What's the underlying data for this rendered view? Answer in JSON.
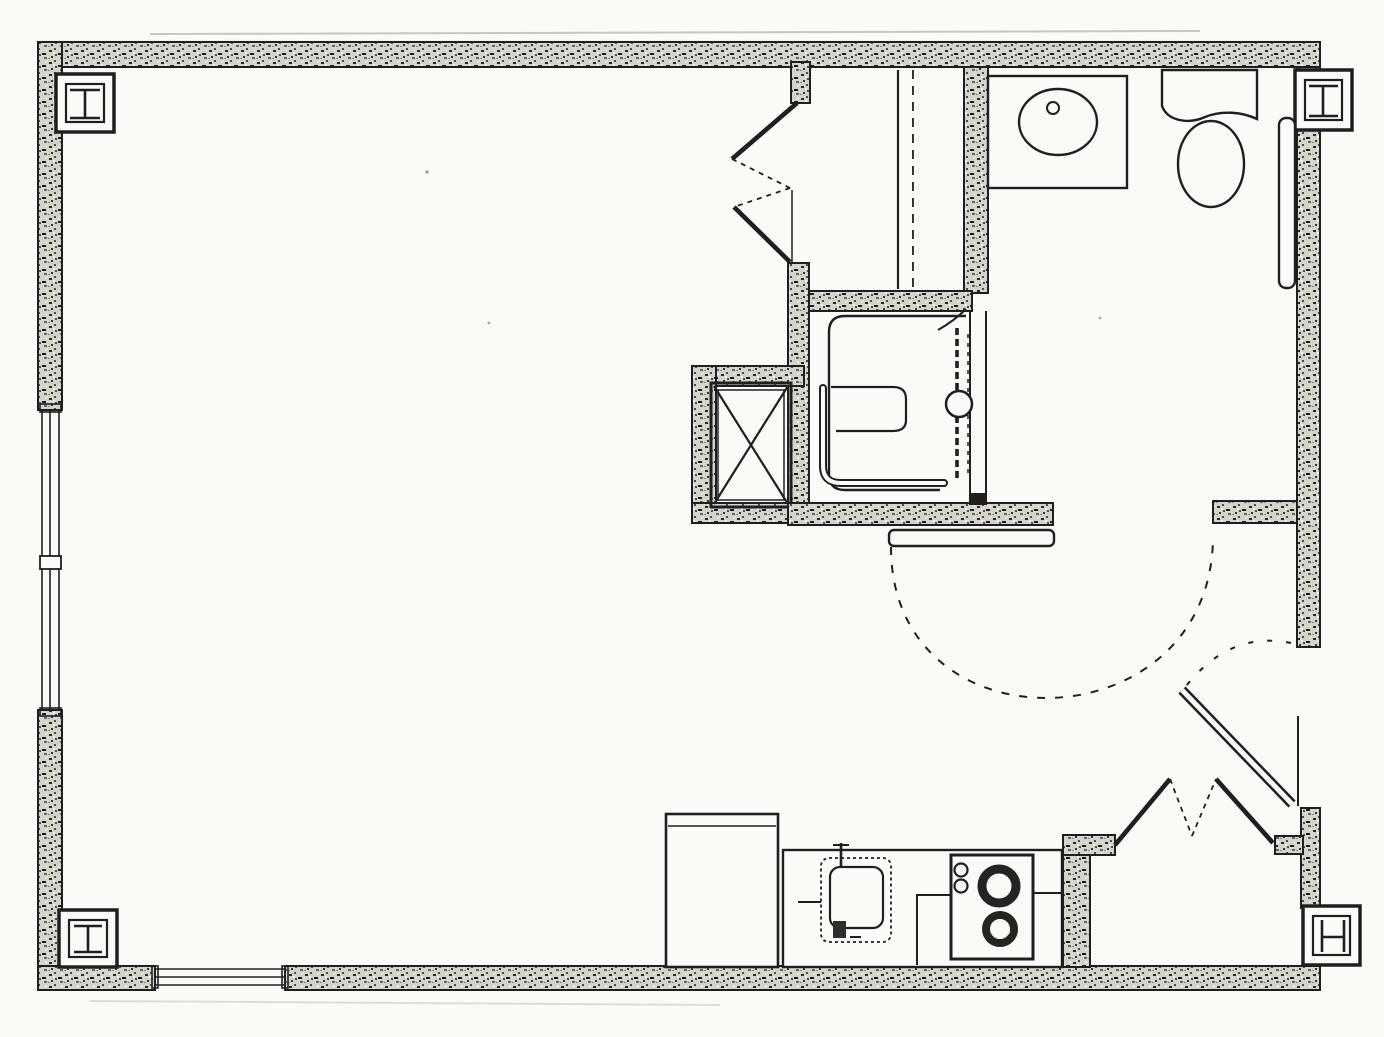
{
  "document": {
    "type": "architectural floor plan",
    "description": "Scanned black-and-white floor plan of a studio apartment with bathroom, shower, closets, kitchen alcove and entry",
    "visible_text": "none"
  },
  "canvas": {
    "width": 1384,
    "height": 1037
  },
  "colors": {
    "paper": "#fbfaf7",
    "ink": "#1f1f1f",
    "wall_fill_base": "#d6d3cc",
    "faint": "#c9c6c0"
  },
  "rooms": [
    {
      "id": "living-area",
      "label": "main living area (unlabeled)"
    },
    {
      "id": "closet",
      "label": "wardrobe closet with rod and shelf, double bifold doors"
    },
    {
      "id": "bathroom",
      "label": "bathroom with vanity sink and toilet"
    },
    {
      "id": "shower",
      "label": "roll-in shower stall with seat and grab bars"
    },
    {
      "id": "utility-shaft",
      "label": "shaft / duct enclosure marked with X"
    },
    {
      "id": "kitchen",
      "label": "kitchenette along bottom wall"
    },
    {
      "id": "entry",
      "label": "entry vestibule with swing door"
    },
    {
      "id": "entry-closet",
      "label": "entry closet with bifold doors"
    }
  ],
  "fixtures": [
    {
      "id": "vanity-sink",
      "label": "vanity counter with oval basin and faucet"
    },
    {
      "id": "toilet",
      "label": "toilet with tank and oval bowl"
    },
    {
      "id": "wall-panel",
      "label": "tall narrow panel on bathroom east wall"
    },
    {
      "id": "shower-pan",
      "label": "shower pan outline"
    },
    {
      "id": "shower-seat",
      "label": "fold-down seat outline"
    },
    {
      "id": "grab-bar",
      "label": "L-shaped grab bar"
    },
    {
      "id": "shower-valve",
      "label": "vertical slide bar with round valve"
    },
    {
      "id": "shaft-x",
      "label": "boxed X symbol"
    },
    {
      "id": "refrigerator",
      "label": "refrigerator"
    },
    {
      "id": "kitchen-sink",
      "label": "counter sink (dashed) with faucet"
    },
    {
      "id": "cooktop",
      "label": "two-burner cooktop with two control knobs"
    },
    {
      "id": "bathroom-sliding-door",
      "label": "bathroom door shown open with 180-degree dashed swing arc"
    },
    {
      "id": "entry-door",
      "label": "entry swing door with dashed arc"
    },
    {
      "id": "closet-bifold-doors",
      "label": "bifold doors, upper closet"
    },
    {
      "id": "entry-bifold-doors",
      "label": "bifold doors, entry closet"
    },
    {
      "id": "window-left",
      "label": "window in left exterior wall with center mullion"
    },
    {
      "id": "window-bottom",
      "label": "window in bottom exterior wall"
    },
    {
      "id": "corner-columns",
      "label": "four steel column symbols at building corners"
    }
  ]
}
